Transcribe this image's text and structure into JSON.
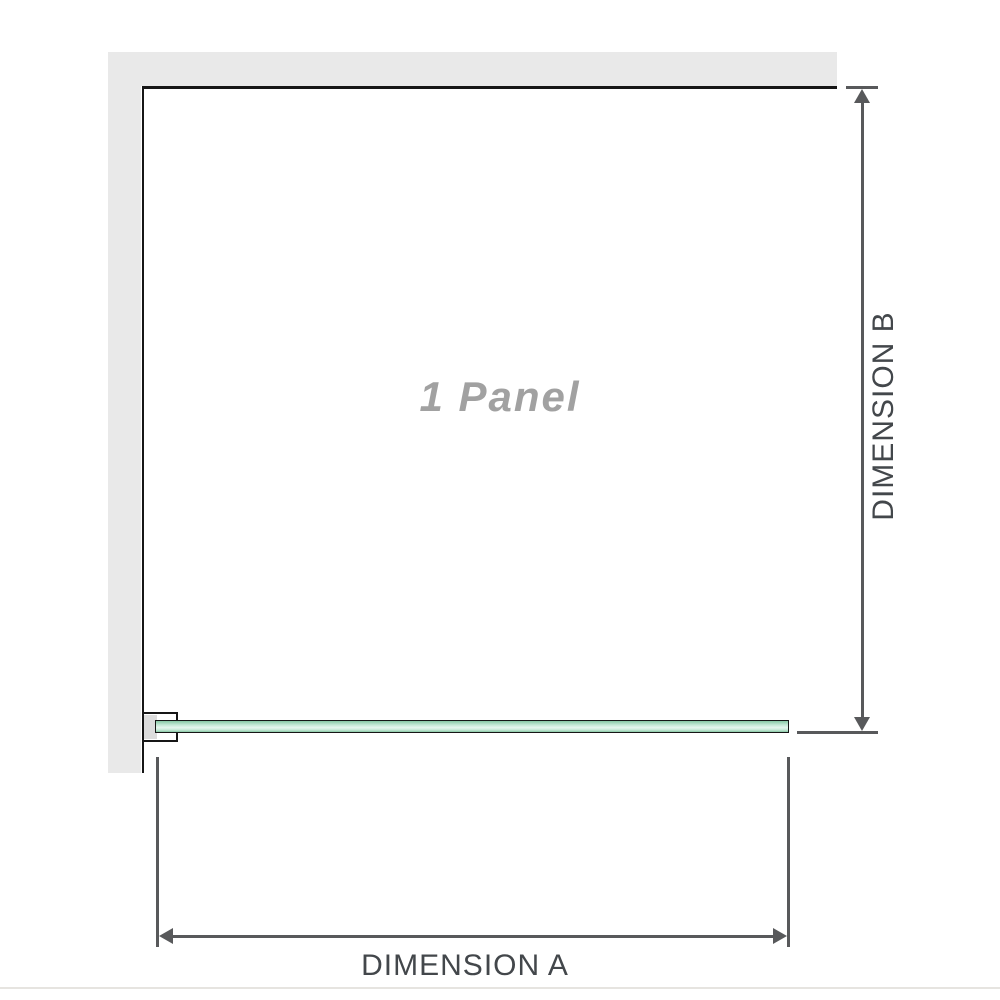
{
  "diagram": {
    "panel_label": "1 Panel",
    "dimension_a_label": "DIMENSION A",
    "dimension_b_label": "DIMENSION B"
  },
  "colors": {
    "bg": "#ffffff",
    "wall_gray": "#e9e9e9",
    "outline_black": "#161616",
    "dim_line": "#58595b",
    "dim_text": "#43474b",
    "panel_text": "#a1a1a1",
    "bracket_gray": "#dcdcdc",
    "glass_dark": "#86c7a4",
    "glass_mid": "#c4e8d5",
    "glass_light": "#e6f6ee",
    "baseline_gray": "#e6e4e0"
  }
}
